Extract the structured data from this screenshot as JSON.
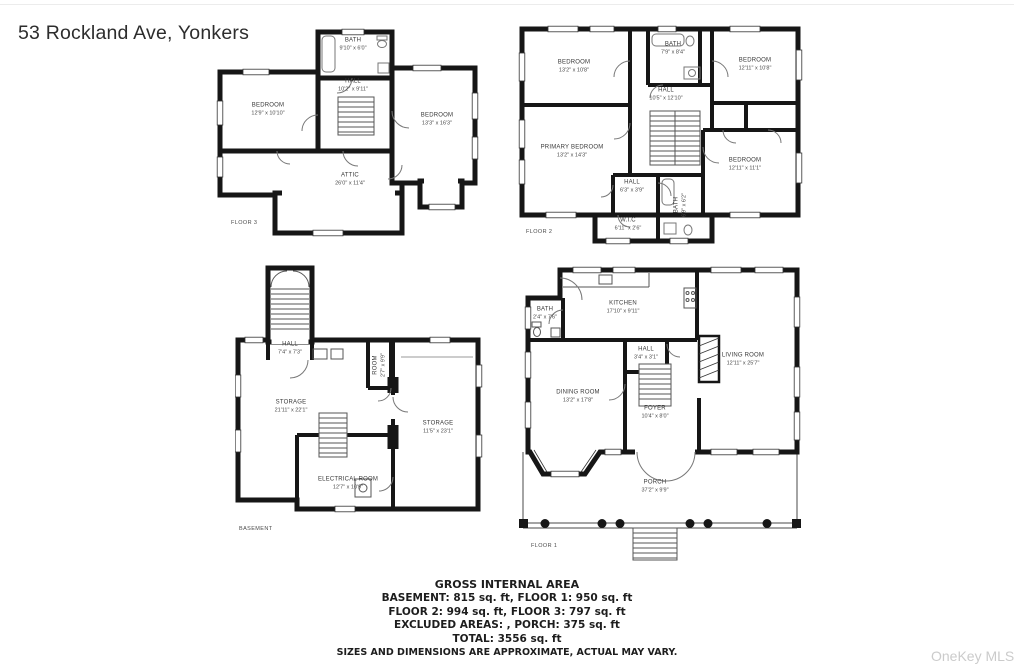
{
  "title": "53 Rockland Ave, Yonkers",
  "watermark": "OneKey MLS",
  "floor3": {
    "label": "FLOOR 3",
    "bath": {
      "name": "BATH",
      "dims": "9'10\" x 6'0\""
    },
    "hall": {
      "name": "HALL",
      "dims": "10'2\" x 9'11\""
    },
    "bedroom_left": {
      "name": "BEDROOM",
      "dims": "12'9\" x 10'10\""
    },
    "bedroom_right": {
      "name": "BEDROOM",
      "dims": "13'3\" x 16'3\""
    },
    "attic": {
      "name": "ATTIC",
      "dims": "26'0\" x 11'4\""
    }
  },
  "floor2": {
    "label": "FLOOR 2",
    "bedroom_top_left": {
      "name": "BEDROOM",
      "dims": "13'2\" x 10'8\""
    },
    "bath_top": {
      "name": "BATH",
      "dims": "7'9\" x 8'4\""
    },
    "bedroom_top_right": {
      "name": "BEDROOM",
      "dims": "12'11\" x 10'8\""
    },
    "hall": {
      "name": "HALL",
      "dims": "10'5\" x 12'10\""
    },
    "primary_bedroom": {
      "name": "PRIMARY BEDROOM",
      "dims": "13'2\" x 14'3\""
    },
    "bedroom_bottom_right": {
      "name": "BEDROOM",
      "dims": "12'11\" x 11'1\""
    },
    "hall_small": {
      "name": "HALL",
      "dims": "6'3\" x 3'9\""
    },
    "wic": {
      "name": "W.I.C",
      "dims": "6'11\" x 2'6\""
    },
    "bath_bottom": {
      "name": "BATH",
      "dims": "6'9\" x 6'2\""
    }
  },
  "basement": {
    "label": "BASEMENT",
    "hall": {
      "name": "HALL",
      "dims": "7'4\" x 7'3\""
    },
    "room": {
      "name": "ROOM",
      "dims": "2'7\" x 9'9\""
    },
    "storage_left": {
      "name": "STORAGE",
      "dims": "21'11\" x 22'1\""
    },
    "storage_right": {
      "name": "STORAGE",
      "dims": "11'5\" x 23'1\""
    },
    "electrical_room": {
      "name": "ELECTRICAL ROOM",
      "dims": "12'7\" x 10'9\""
    }
  },
  "floor1": {
    "label": "FLOOR 1",
    "kitchen": {
      "name": "KITCHEN",
      "dims": "17'10\" x 9'11\""
    },
    "bath": {
      "name": "BATH",
      "dims": "2'4\" x 7'6\""
    },
    "hall": {
      "name": "HALL",
      "dims": "3'4\" x 3'1\""
    },
    "living_room": {
      "name": "LIVING ROOM",
      "dims": "12'11\" x 25'7\""
    },
    "dining_room": {
      "name": "DINING ROOM",
      "dims": "13'2\" x 17'8\""
    },
    "foyer": {
      "name": "FOYER",
      "dims": "10'4\" x 8'0\""
    },
    "porch": {
      "name": "PORCH",
      "dims": "37'2\" x 9'9\""
    }
  },
  "summary": {
    "heading": "GROSS INTERNAL AREA",
    "line1": "BASEMENT: 815 sq. ft, FLOOR 1: 950 sq. ft",
    "line2": "FLOOR 2: 994 sq. ft, FLOOR 3: 797 sq. ft",
    "line3": "EXCLUDED AREAS: , PORCH: 375 sq. ft",
    "line4": "TOTAL: 3556 sq. ft",
    "disclaimer": "SIZES AND DIMENSIONS ARE APPROXIMATE, ACTUAL MAY VARY."
  }
}
